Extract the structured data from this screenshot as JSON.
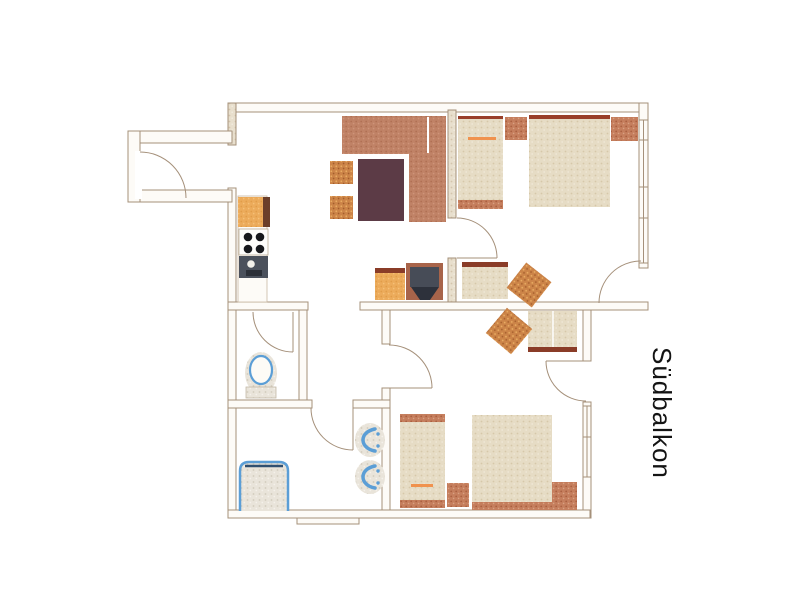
{
  "floorplan": {
    "balcony_label": "Südbalkon",
    "colors": {
      "background": "#ffffff",
      "wall_line": "#a5907a",
      "wall_fill_speckle": "#e8dfcd",
      "sofa_terracotta": "#c08266",
      "table_dark_brown": "#5c3b46",
      "chair_orange_speckle": "#cc8448",
      "bed_beige": "#e6dcc5",
      "accent_terracotta": "#c57e5d",
      "headboard_dark_red": "#993f2a",
      "trim_dark_red": "#8a3c28",
      "pillow_stripe_orange": "#f0924e",
      "kitchen_counter_orange": "#ecab5b",
      "kitchen_counter_stripe": "#6b3f2a",
      "appliance_slate": "#474c57",
      "appliance_dark": "#2d313b",
      "burner_black": "#17181c",
      "fixture_blue": "#5b9ed6",
      "tub_rim_navy": "#2f4f70",
      "label_text": "#141414"
    }
  }
}
